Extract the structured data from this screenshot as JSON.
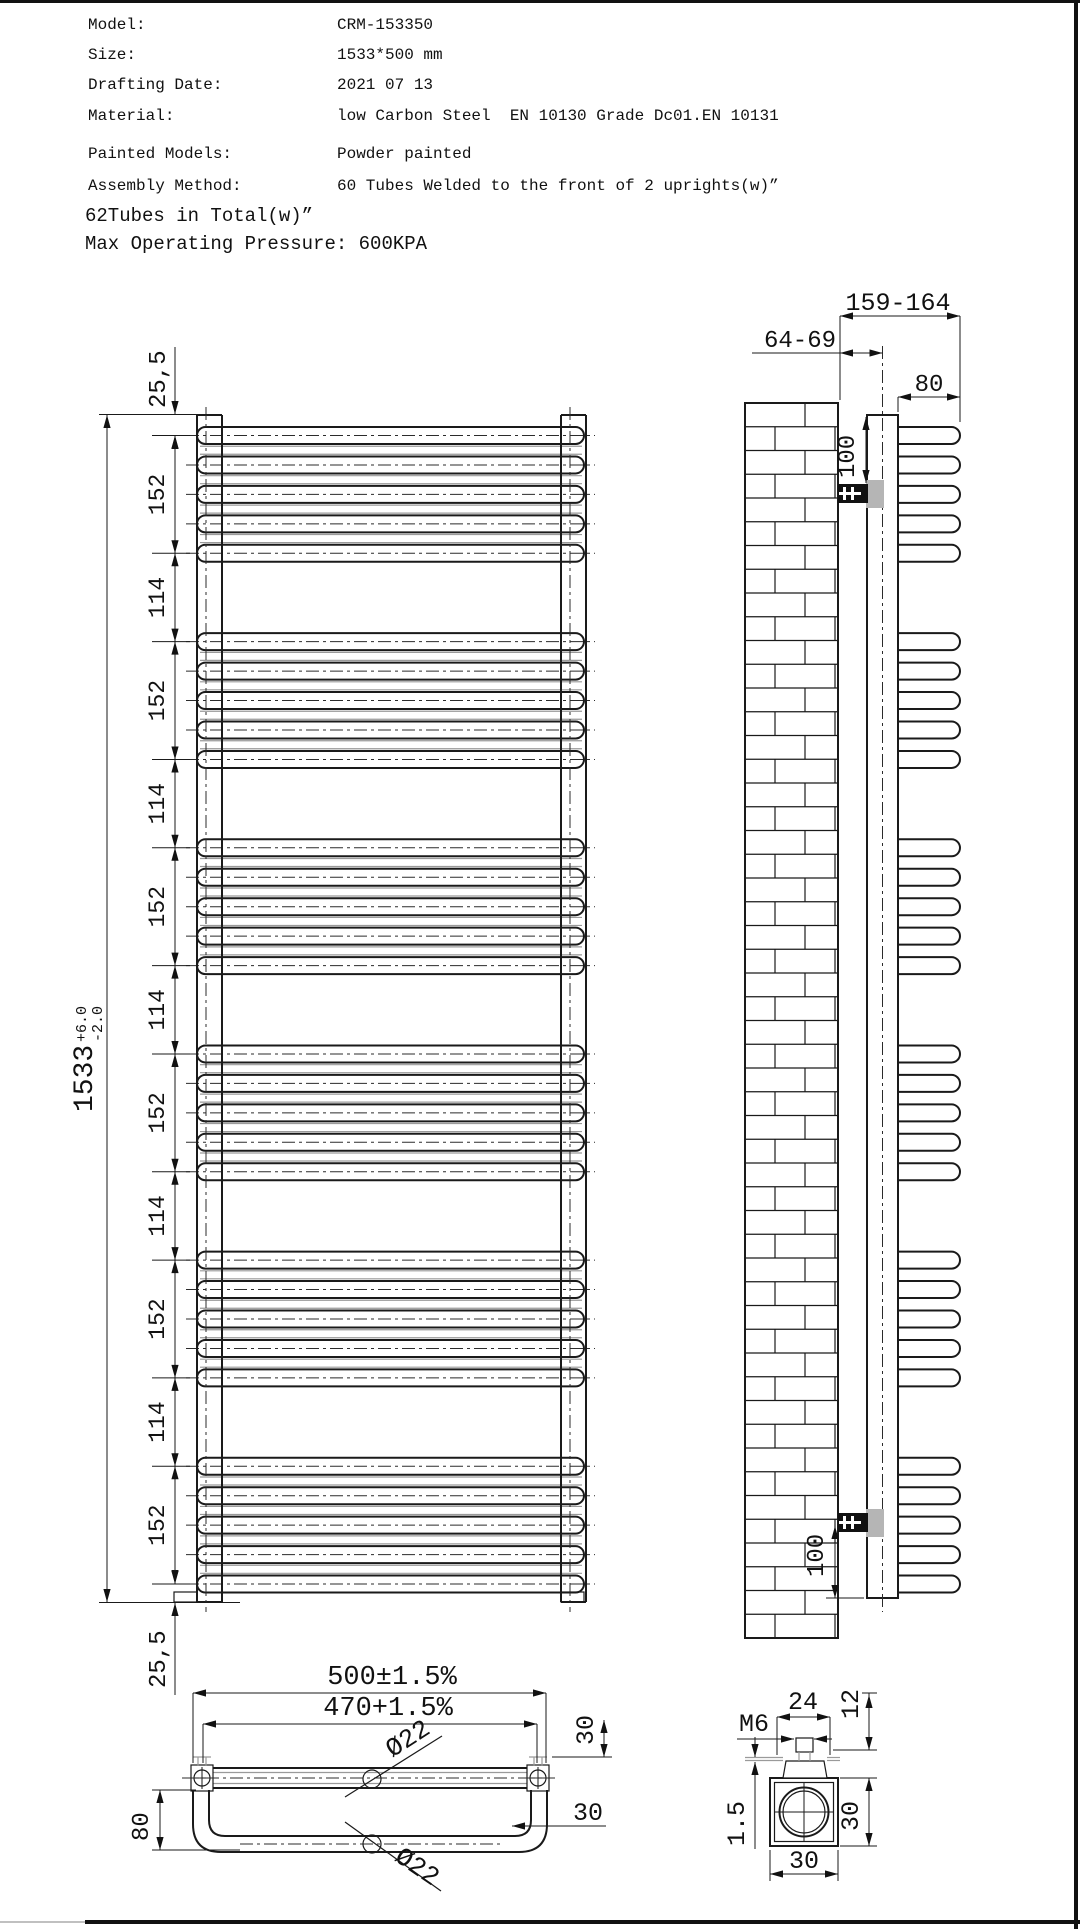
{
  "title_block": {
    "rows": [
      {
        "label": "Model:",
        "value": "CRM-153350"
      },
      {
        "label": "Size:",
        "value": "1533*500 mm"
      },
      {
        "label": "Drafting Date:",
        "value": "2021 07 13"
      },
      {
        "label": "Material:",
        "value": "low Carbon Steel  EN 10130 Grade Dc01.EN 10131"
      },
      {
        "label": "Painted Models:",
        "value": "Powder painted"
      },
      {
        "label": "Assembly Method:",
        "value": "60 Tubes Welded to the front of 2 uprights(w)”"
      }
    ],
    "notes": [
      "62Tubes in Total(w)”",
      "Max Operating Pressure: 600KPA"
    ]
  },
  "front_view": {
    "overall_height": "1533",
    "tol_plus": "+6.0",
    "tol_minus": "-2.0",
    "offset_top": "25,5",
    "offset_bottom": "25,5",
    "chain": [
      "152",
      "114",
      "152",
      "114",
      "152",
      "114",
      "152",
      "114",
      "152",
      "114",
      "152"
    ],
    "groups": 6,
    "tubes_per_group": 5
  },
  "side_view": {
    "total_depth": "159-164",
    "wall_to_upright": "64-69",
    "loop_depth": "80",
    "bracket_top": "100",
    "bracket_bottom": "100"
  },
  "plan_view": {
    "overall_width": "500±1.5%",
    "hole_centers": "470+1.5%",
    "tube_dia_top": "Ø22",
    "tube_dia_bottom": "Ø22",
    "loop_depth": "80",
    "corner_offset": "30",
    "side_offset": "30"
  },
  "detail_view": {
    "bracket_width": "24",
    "thread": "M6",
    "bolt_height": "12",
    "profile_height": "30",
    "profile_width": "30",
    "wall_thickness": "1.5"
  },
  "colors": {
    "line": "#1a1a1a",
    "light": "#9a9a9a",
    "background": "#ffffff"
  }
}
